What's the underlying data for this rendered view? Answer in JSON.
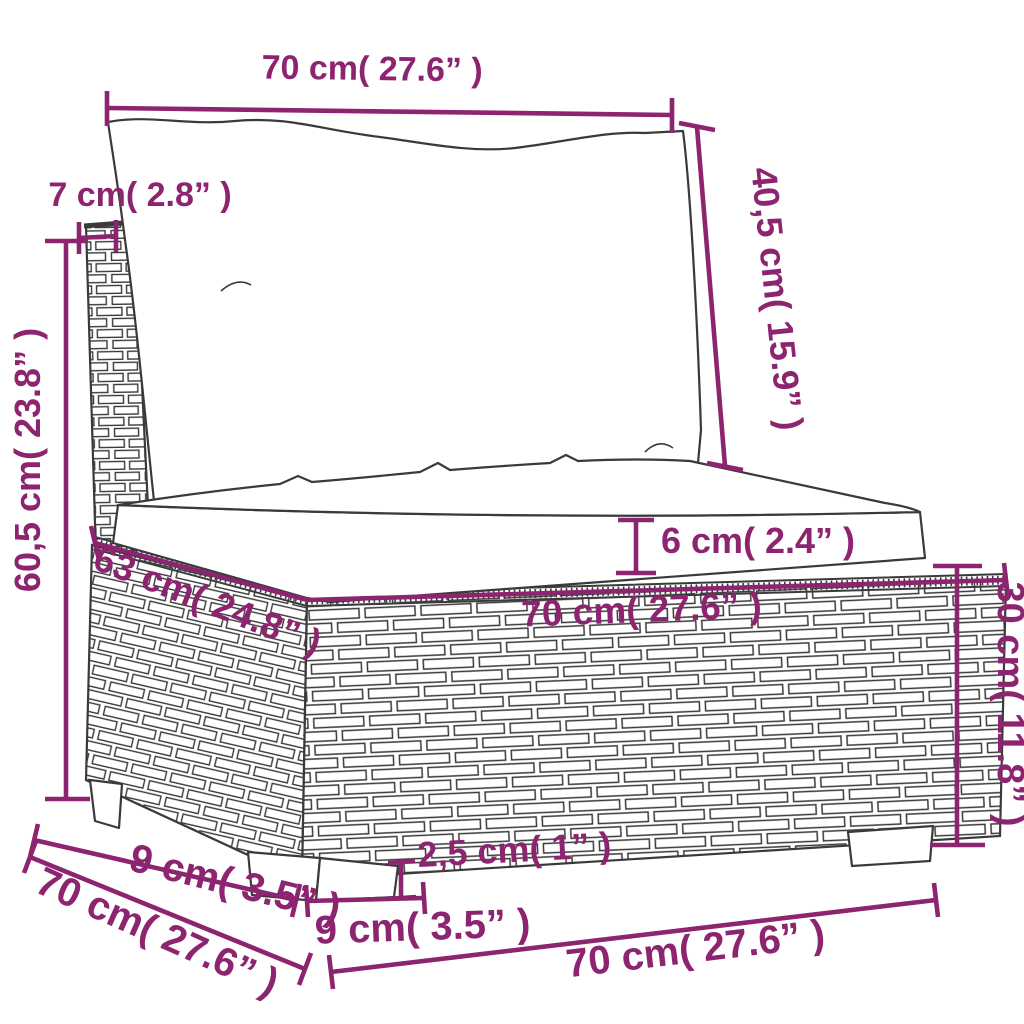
{
  "diagram": {
    "type": "furniture-dimension-diagram",
    "subject": "poly rattan garden sofa middle section with cushions",
    "accent_color": "#8d2470",
    "line_color": "#3a3a3a",
    "background_color": "#ffffff",
    "labels": {
      "back_cushion_width": "70 cm( 27.6” )",
      "back_panel_thickness": "7 cm( 2.8” )",
      "total_height": "60,5 cm( 23.8” )",
      "back_cushion_height": "40,5 cm( 15.9” )",
      "seat_cushion_thickness": "6 cm( 2.4” )",
      "seat_top_depth": "63 cm( 24.8” )",
      "seat_front_width": "70 cm( 27.6” )",
      "base_height": "30 cm( 11.8” )",
      "leg_offset_depth": "9 cm( 3.5” )",
      "base_depth": "70 cm( 27.6” )",
      "leg_height": "2,5 cm( 1” )",
      "leg_width": "9 cm( 3.5” )",
      "base_width": "70 cm( 27.6” )"
    }
  }
}
